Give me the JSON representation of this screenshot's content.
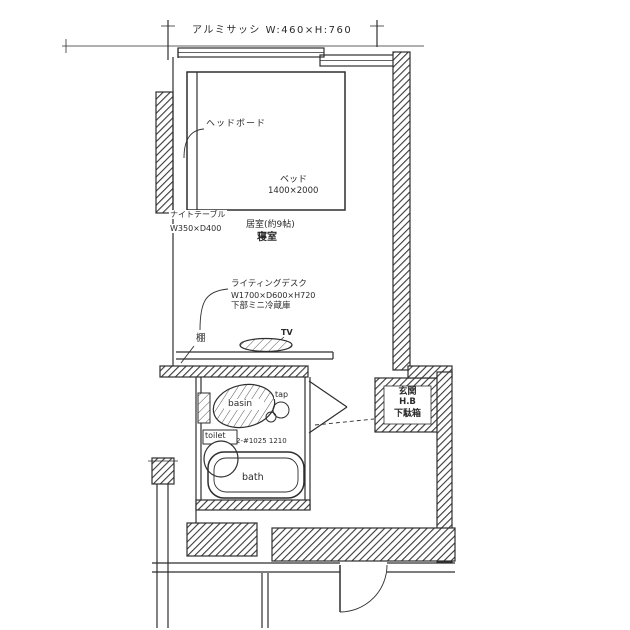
{
  "drawing": {
    "window_spec": "アルミサッシ W:460×H:760",
    "headboard": "ヘッドボード",
    "bed": "ベッド",
    "bed_size": "1400×2000",
    "night_table": "ナイトテーブル",
    "night_table_size": "W350×D400",
    "room_size": "居室(約9帖)",
    "room_name": "寝室",
    "desk": "ライティングデスク",
    "desk_size": "W1700×D600×H720",
    "desk_note": "下部ミニ冷蔵庫",
    "shelf": "棚",
    "tv": "TV",
    "basin": "basin",
    "tap": "tap",
    "toilet": "toilet",
    "bath_size": "2-#1025 1210",
    "bath": "bath",
    "entrance": "玄関",
    "entrance_mid": "H.B",
    "shoe_cabinet": "下駄箱"
  },
  "colors": {
    "ink": "#2e2e2e",
    "paper": "#ffffff"
  }
}
